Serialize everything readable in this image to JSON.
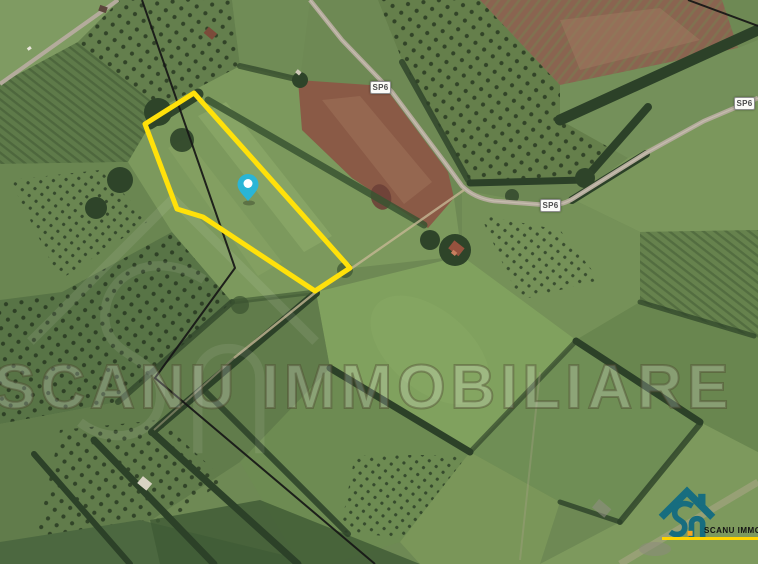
{
  "watermark": {
    "text": "SCANU IMMOBILIARE"
  },
  "logo": {
    "text": "SCANU IMMOBILIARE",
    "icon": "house-s-monogram",
    "icon_color": "#176D7F",
    "accent_color": "#FFD400"
  },
  "map": {
    "road_labels": [
      {
        "text": "SP6",
        "x": 370,
        "y": 81
      },
      {
        "text": "SP6",
        "x": 540,
        "y": 199
      },
      {
        "text": "SP6",
        "x": 734,
        "y": 97
      }
    ],
    "marker": {
      "x": 248,
      "y": 201,
      "color": "#2AB5D6"
    },
    "boundary": {
      "color": "#FFE10A",
      "stroke_width": 5,
      "points": "194,93 145,124 177,209 203,217 315,291 350,268"
    },
    "power_lines": [
      "142,0 235,268 155,378 375,564",
      "688,0 758,26"
    ]
  }
}
